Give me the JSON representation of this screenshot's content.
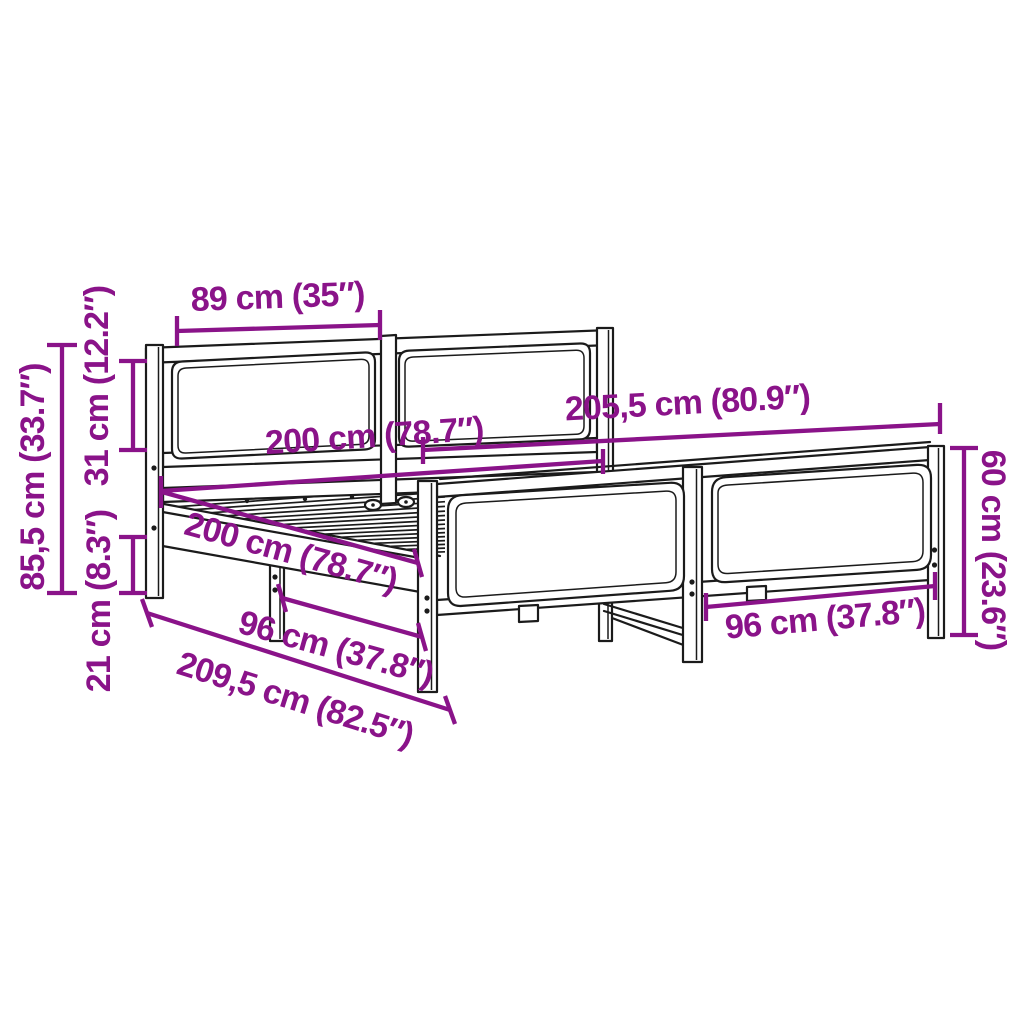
{
  "diagram": {
    "type": "bed-frame-dimension-diagram",
    "colors": {
      "background": "#ffffff",
      "outline": "#1b1b1b",
      "annotation": "#8A1389"
    },
    "dimensions": {
      "headboard_panel_width": "89 cm (35″)",
      "headboard_total_height": "85,5 cm (33.7″)",
      "headboard_panel_height": "31 cm (12.2″)",
      "under_frame_clearance": "21 cm (8.3″)",
      "inner_width": "200 cm (78.7″)",
      "total_width": "205,5 cm (80.9″)",
      "inner_length": "200 cm (78.7″)",
      "front_leg_spacing": "96 cm (37.8″)",
      "total_length": "209,5 cm (82.5″)",
      "footboard_panel_width": "96 cm (37.8″)",
      "footboard_height": "60 cm (23.6″)"
    }
  }
}
